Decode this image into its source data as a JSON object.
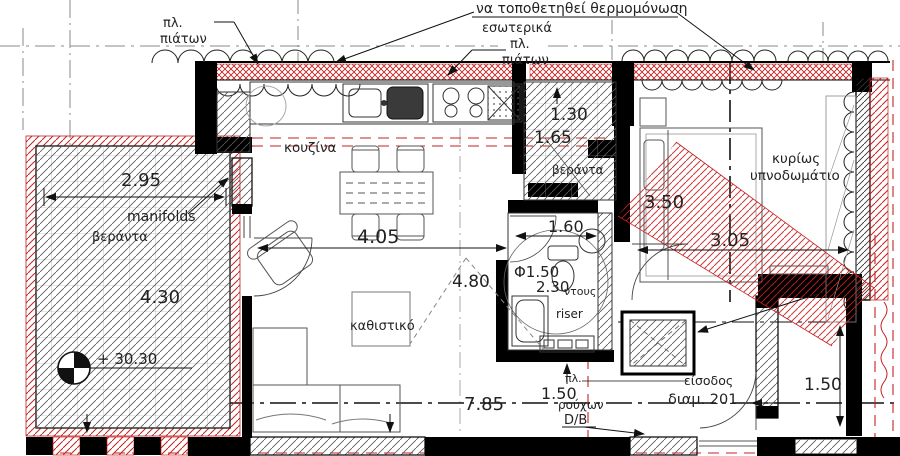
{
  "labels": {
    "note": "να τοποθετηθεί θερμομόνωση",
    "interior": "εσωτερικά",
    "pl_a": "πλ.",
    "platon_a": "πιάτων",
    "pl_b": "πλ.",
    "platon_b": "πιάτων",
    "kitchen": "κουζίνα",
    "veranda_left": "βεράντα",
    "veranda_mid": "βεράντα",
    "manifolds": "manifolds",
    "living": "καθιστικό",
    "bedroom_line1": "κυρίως",
    "bedroom_line2": "υπνοδωμάτιο",
    "shower": "ντους",
    "riser": "riser",
    "laundry_pl": "πλ.",
    "laundry_word": "ρούχων",
    "db": "D/B",
    "entrance": "είσοδος",
    "apartment": "διαμ. 201",
    "level": "+ 30.30"
  },
  "dimensions": {
    "balcony_w": "2.95",
    "balcony_h": "4.30",
    "living_w": "4.05",
    "living_d": "4.80",
    "veranda_w": "1.30",
    "veranda_h": "1.65",
    "bath_w": "1.60",
    "circle": "Φ1.50",
    "bath_l": "2.30",
    "bed_side": "3.50",
    "bed_w": "3.05",
    "total_w": "7.85",
    "laundry": "1.50",
    "corridor": "1.50"
  },
  "colors": {
    "red": "#c42222",
    "line": "#1a1a1a",
    "gray": "#777"
  }
}
